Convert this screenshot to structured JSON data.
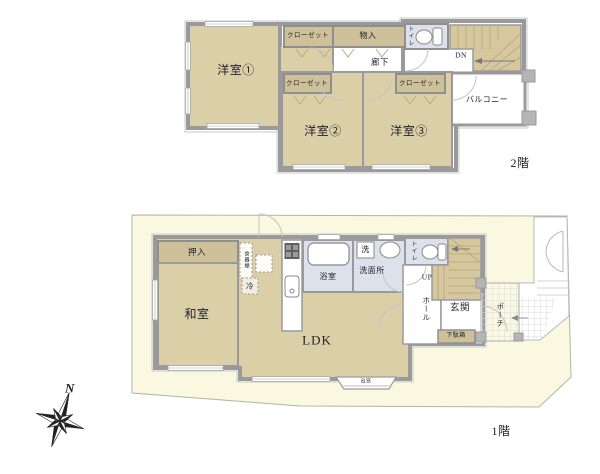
{
  "floor2": {
    "label": "2階",
    "rooms": {
      "room1": "洋室①",
      "room2": "洋室②",
      "room3": "洋室③",
      "closet1": "クローゼット",
      "closet2": "クローゼット",
      "closet3": "クローゼット",
      "storage": "物入",
      "toilet": "トイレ",
      "hallway": "廊下",
      "stairs_down": "DN",
      "balcony": "バルコニー"
    }
  },
  "floor1": {
    "label": "1階",
    "rooms": {
      "japanese_room": "和室",
      "oshiire": "押入",
      "cupboard": "食器棚",
      "refrigerator": "冷",
      "ldk": "LDK",
      "bathroom": "浴室",
      "washer": "洗",
      "washroom": "洗面所",
      "toilet": "トイレ",
      "stairs_up": "UP",
      "hall": "ホール",
      "entrance": "玄関",
      "shoe_cabinet": "下駄箱",
      "porch": "ポーチ",
      "bay_window": "出窓"
    }
  },
  "compass": {
    "north": "N"
  },
  "colors": {
    "room_fill": "#dbcfa7",
    "closet_fill": "#cec19a",
    "stairs_fill": "#d6c79e",
    "wet_area_fill": "#dce1eb",
    "wall": "#9a9a9c",
    "lot_fill": "#faf8e0",
    "text": "#23232f"
  }
}
